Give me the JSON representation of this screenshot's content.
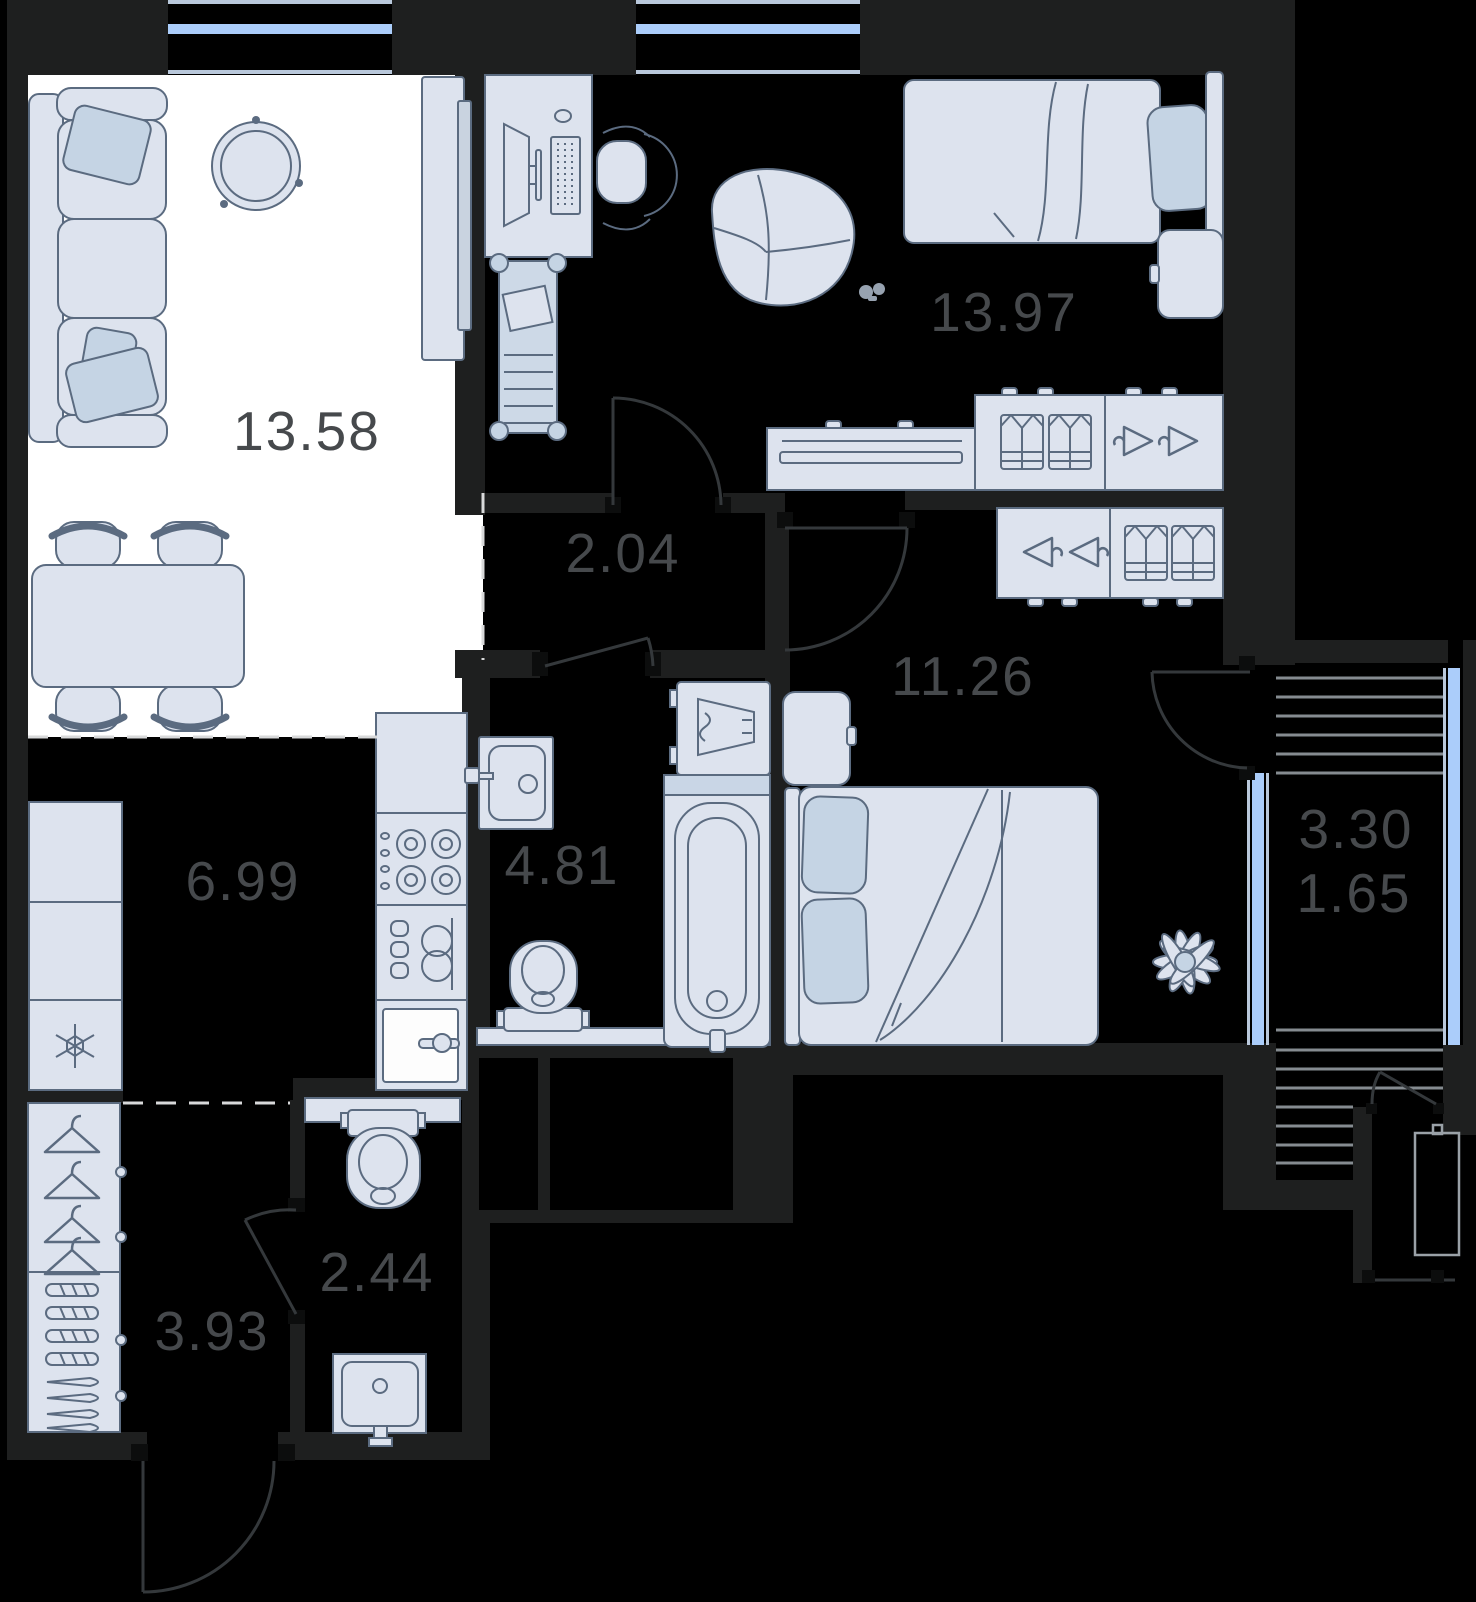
{
  "floorplan": {
    "background": "#000000",
    "wall_color": "#1e1f1f",
    "living_zone_color": "#ffffff",
    "furniture_fill": "#dde3ee",
    "furniture_accent": "#c5d4e4",
    "outline_color": "#5b6b80",
    "window_color": "#abcdfa",
    "label_color": "#46494c",
    "rooms": [
      {
        "id": "living-dining",
        "area": "13.58"
      },
      {
        "id": "bedroom-top",
        "area": "13.97"
      },
      {
        "id": "corridor",
        "area": "2.04"
      },
      {
        "id": "bedroom-right",
        "area": "11.26"
      },
      {
        "id": "kitchen",
        "area": "6.99"
      },
      {
        "id": "bathroom",
        "area": "4.81"
      },
      {
        "id": "balcony",
        "area_total": "3.30",
        "area_reduced": "1.65"
      },
      {
        "id": "wc",
        "area": "2.44"
      },
      {
        "id": "entry-hall",
        "area": "3.93"
      }
    ]
  }
}
